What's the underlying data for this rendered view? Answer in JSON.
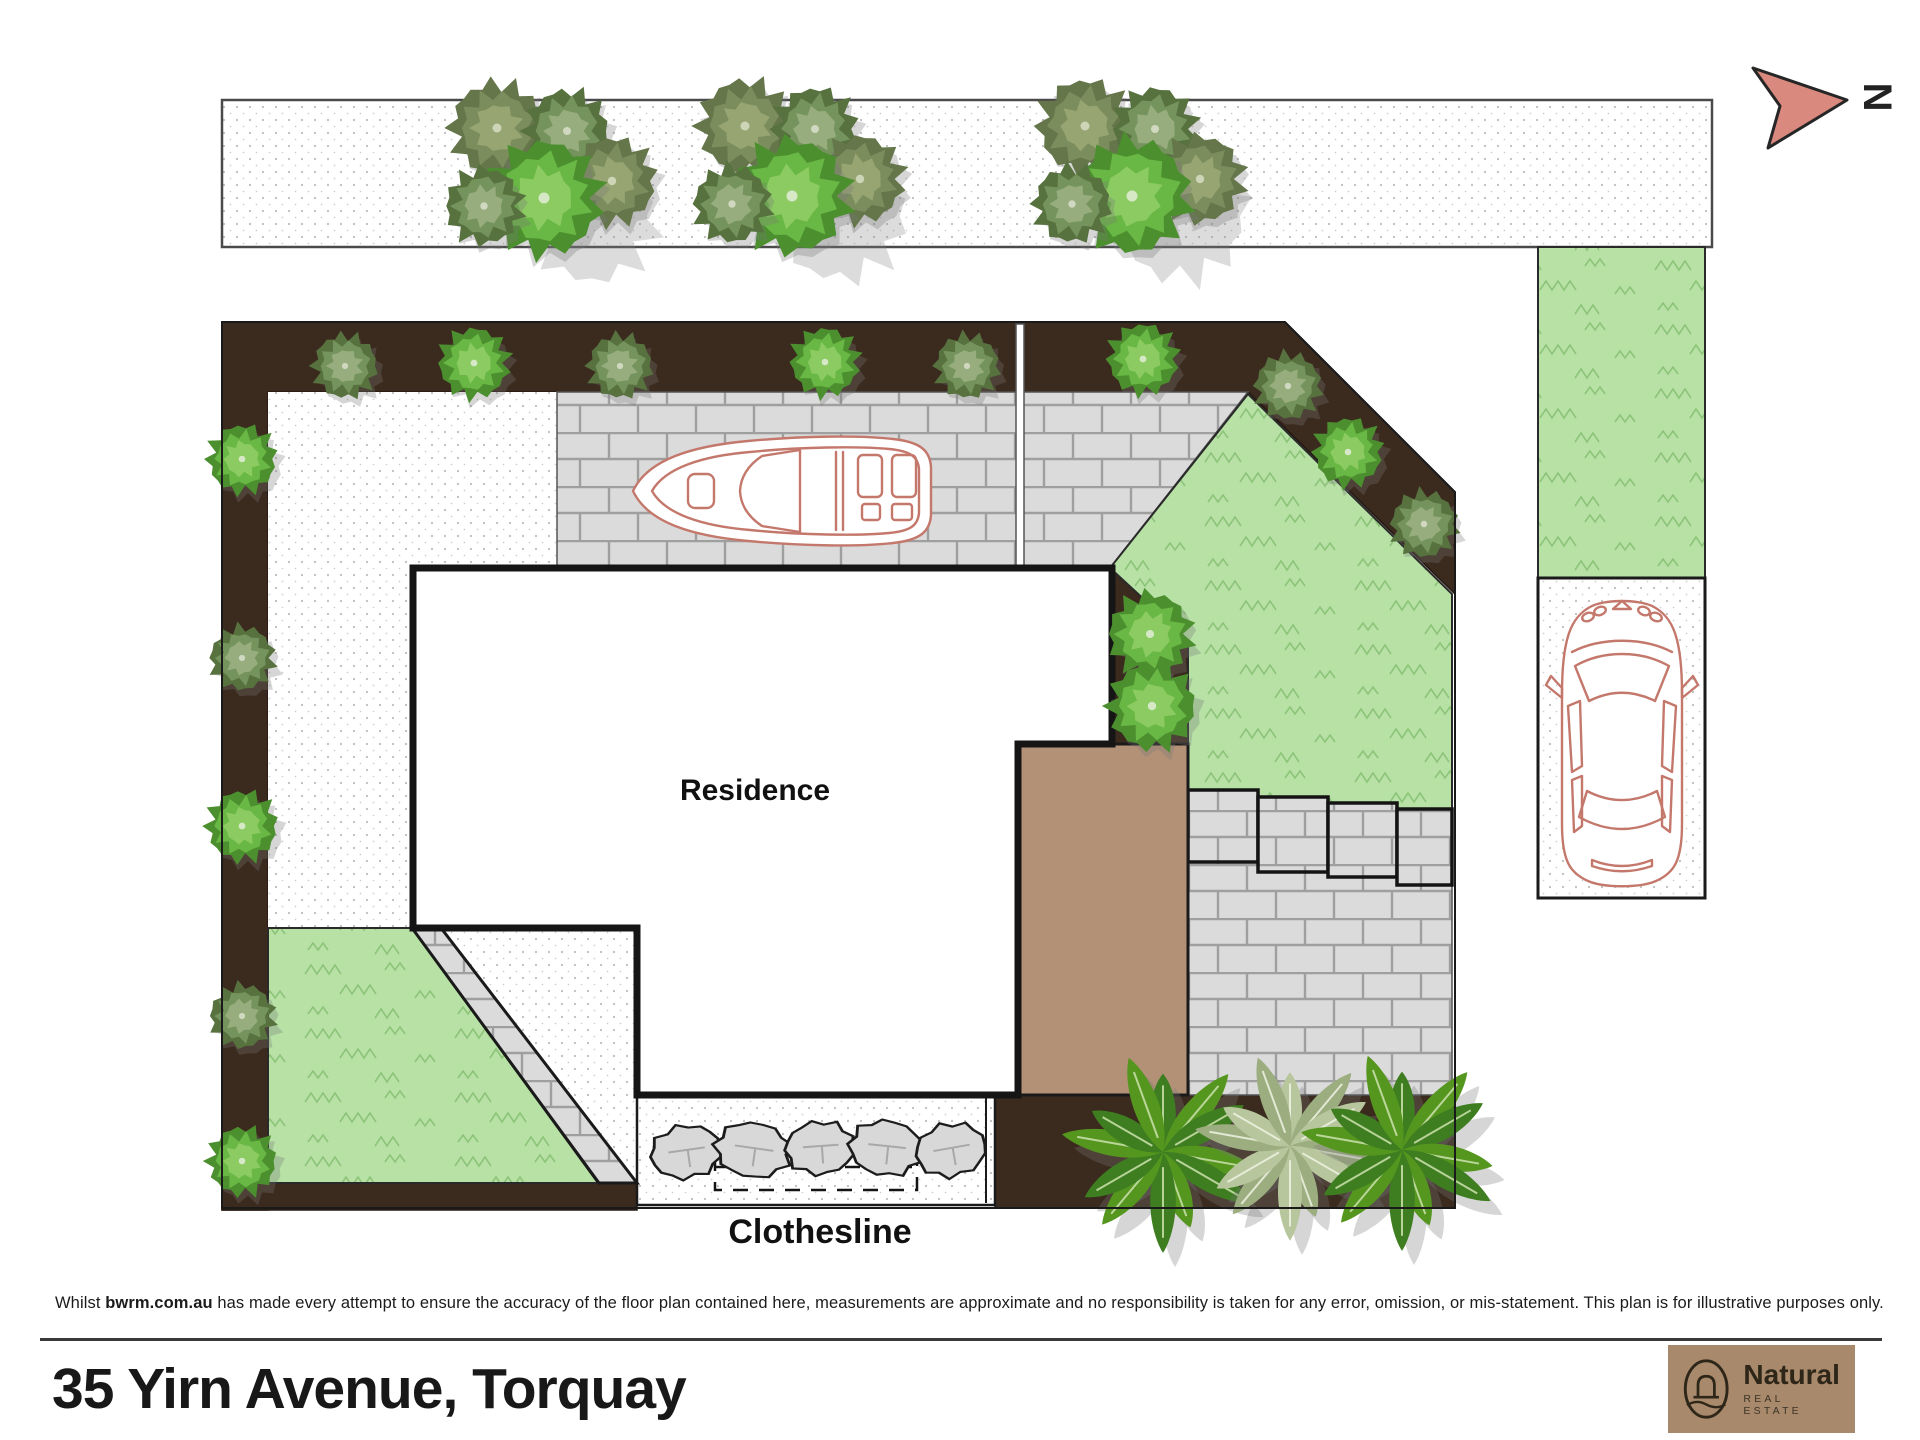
{
  "compass": {
    "label": "N"
  },
  "plan": {
    "residence_label": "Residence",
    "clothesline_label": "Clothesline"
  },
  "footer": {
    "disclaimer_prefix": "Whilst ",
    "disclaimer_site": "bwrm.com.au",
    "disclaimer_rest": " has made every attempt to ensure the accuracy of the floor plan contained here, measurements are approximate and no responsibility is taken for any error, omission, or mis-statement. This plan is for illustrative purposes only.",
    "address": "35 Yirn Avenue, Torquay"
  },
  "logo": {
    "brand": "Natural",
    "tagline": "REAL ESTATE"
  },
  "colors": {
    "bed": "#3b2a1e",
    "deck": "#b29176",
    "grass": "#b7e1a5",
    "grass_stroke": "#7eba6b",
    "brick": "#dbdbdb",
    "mortar": "#9f9f9f",
    "vehicle": "#c4786c",
    "arrow": "#d9897d",
    "logo_bg": "#a8896b",
    "dot": "#bdbdbd"
  },
  "palettes": {
    "bright": [
      "#4c8f2f",
      "#69b744",
      "#8bcb62",
      "#d6e8c6"
    ],
    "sage": [
      "#57713f",
      "#75935c",
      "#97ad7e",
      "#d0d9c0"
    ],
    "olive": [
      "#64764a",
      "#7c8d5d",
      "#97a573",
      "#cdd5b6"
    ],
    "palm_green": [
      "#3e7d20",
      "#55961f",
      "#2f6a16",
      "#cde2ae"
    ],
    "palm_sage": [
      "#b7c69d",
      "#9cae80",
      "#8da076",
      "#eef2e2"
    ]
  },
  "decor": {
    "tree_clusters": [
      {
        "x": 552,
        "y": 166
      },
      {
        "x": 800,
        "y": 164
      },
      {
        "x": 1140,
        "y": 164
      }
    ],
    "bushes": [
      {
        "x": 345,
        "y": 366,
        "r": 31,
        "t": "sage"
      },
      {
        "x": 474,
        "y": 363,
        "r": 34,
        "t": "bright"
      },
      {
        "x": 620,
        "y": 366,
        "r": 31,
        "t": "sage"
      },
      {
        "x": 825,
        "y": 362,
        "r": 33,
        "t": "bright"
      },
      {
        "x": 967,
        "y": 366,
        "r": 31,
        "t": "sage"
      },
      {
        "x": 1143,
        "y": 359,
        "r": 34,
        "t": "bright"
      },
      {
        "x": 1288,
        "y": 386,
        "r": 32,
        "t": "sage"
      },
      {
        "x": 1348,
        "y": 452,
        "r": 33,
        "t": "bright"
      },
      {
        "x": 1424,
        "y": 524,
        "r": 32,
        "t": "sage"
      },
      {
        "x": 242,
        "y": 459,
        "r": 33,
        "t": "bright"
      },
      {
        "x": 242,
        "y": 658,
        "r": 31,
        "t": "sage"
      },
      {
        "x": 242,
        "y": 826,
        "r": 34,
        "t": "bright"
      },
      {
        "x": 242,
        "y": 1016,
        "r": 31,
        "t": "sage"
      },
      {
        "x": 242,
        "y": 1161,
        "r": 33,
        "t": "bright"
      },
      {
        "x": 1150,
        "y": 634,
        "r": 40,
        "t": "bright"
      },
      {
        "x": 1152,
        "y": 706,
        "r": 42,
        "t": "bright"
      }
    ],
    "palms": [
      {
        "x": 1163,
        "y": 1152,
        "r": 98,
        "t": "green"
      },
      {
        "x": 1290,
        "y": 1146,
        "r": 92,
        "t": "sage"
      },
      {
        "x": 1402,
        "y": 1150,
        "r": 98,
        "t": "green"
      }
    ],
    "stones": [
      {
        "x": 686,
        "y": 1152,
        "rx": 35,
        "ry": 26,
        "a": -8
      },
      {
        "x": 753,
        "y": 1150,
        "rx": 37,
        "ry": 27,
        "a": 8
      },
      {
        "x": 820,
        "y": 1148,
        "rx": 34,
        "ry": 26,
        "a": -4
      },
      {
        "x": 886,
        "y": 1148,
        "rx": 36,
        "ry": 27,
        "a": 6
      },
      {
        "x": 951,
        "y": 1150,
        "rx": 35,
        "ry": 26,
        "a": -10
      }
    ]
  }
}
